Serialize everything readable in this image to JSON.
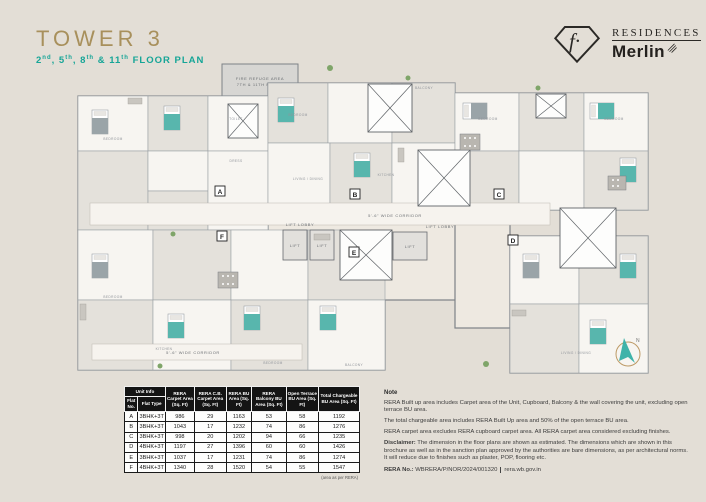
{
  "colors": {
    "accent_gold": "#a8905c",
    "accent_teal": "#16a597",
    "bed_teal": "#58b6ad",
    "table_header_bg": "#141414",
    "background": "#e3ded6"
  },
  "header": {
    "title": "TOWER 3",
    "sub": {
      "s0": "2",
      "sup0": "nd",
      "s1": ", 5",
      "sup1": "th",
      "s2": ", 8",
      "sup2": "th",
      "s3": " & 11",
      "sup3": "th",
      "s4": " FLOOR PLAN"
    }
  },
  "logo": {
    "monogram": "f·",
    "brand_top": "RESIDENCES",
    "brand_bottom": "Merlin"
  },
  "plan": {
    "fire_refuge_line1": "FIRE REFUGE AREA",
    "fire_refuge_line2": "7TH & 11TH FLOOR",
    "corridor_label": "5'-6\" WIDE CORRIDOR",
    "lift_lobby_label": "LIFT LOBBY",
    "lift_label": "LIFT",
    "units": [
      "A",
      "B",
      "C",
      "D",
      "E",
      "F"
    ],
    "compass_n": "N",
    "room_labels": {
      "bedroom": "BEDROOM",
      "living_dining": "LIVING / DINING",
      "kitchen": "KITCHEN",
      "toilet": "TOILET",
      "balcony": "BALCONY",
      "dress": "DRESS"
    }
  },
  "table": {
    "header": {
      "unit_info": "Unit Info",
      "flat_no": "Flat No.",
      "flat_type": "Flat Type",
      "carpet": "RERA Carpet Area (Sq. Ft)",
      "cb_carpet": "RERA C.B. Carpet Area (Sq. Ft)",
      "bu": "RERA BU Area (Sq. Ft)",
      "balcony_bu": "RERA Balcony BU Area (Sq. Ft)",
      "terrace_bu": "Open Terrace BU Area (Sq. Ft)",
      "total_bu": "Total Chargeable BU Area (Sq. Ft)"
    },
    "rows": [
      {
        "no": "A",
        "type": "3BHK+3T",
        "carpet": "986",
        "cb": "29",
        "bu": "1163",
        "balcony": "53",
        "terrace": "58",
        "total": "1192"
      },
      {
        "no": "B",
        "type": "3BHK+3T",
        "carpet": "1043",
        "cb": "17",
        "bu": "1232",
        "balcony": "74",
        "terrace": "86",
        "total": "1276"
      },
      {
        "no": "C",
        "type": "3BHK+3T",
        "carpet": "998",
        "cb": "20",
        "bu": "1202",
        "balcony": "94",
        "terrace": "66",
        "total": "1235"
      },
      {
        "no": "D",
        "type": "4BHK+3T",
        "carpet": "1197",
        "cb": "27",
        "bu": "1396",
        "balcony": "60",
        "terrace": "60",
        "total": "1426"
      },
      {
        "no": "E",
        "type": "3BHK+3T",
        "carpet": "1037",
        "cb": "17",
        "bu": "1231",
        "balcony": "74",
        "terrace": "86",
        "total": "1274"
      },
      {
        "no": "F",
        "type": "4BHK+3T",
        "carpet": "1340",
        "cb": "28",
        "bu": "1520",
        "balcony": "54",
        "terrace": "55",
        "total": "1547"
      }
    ],
    "footnote": "(area as per RERA)"
  },
  "notes": {
    "title": "Note",
    "p1": "RERA Built up area includes Carpet area of the Unit, Cupboard, Balcony & the wall covering the unit, excluding open terrace BU area.",
    "p2": "The total chargeable area includes RERA Built Up area and 50% of the open terrace BU area.",
    "p3": "RERA carpet area excludes RERA cupboard carpet area. All RERA carpet area considered excluding finishes.",
    "disclaimer_label": "Disclaimer:",
    "disclaimer_text": "The dimension in the floor plans are shown as estimated. The dimensions which are shown in this brochure as well as in the sanction plan approved by the authorities are bare dimensions, as per architectural norms. It will reduce due to finishes such as plaster, POP, flooring etc.",
    "rera_label": "RERA No.:",
    "rera_number": "WBRERA/P/NOR/2024/001320",
    "rera_site": "rera.wb.gov.in"
  }
}
